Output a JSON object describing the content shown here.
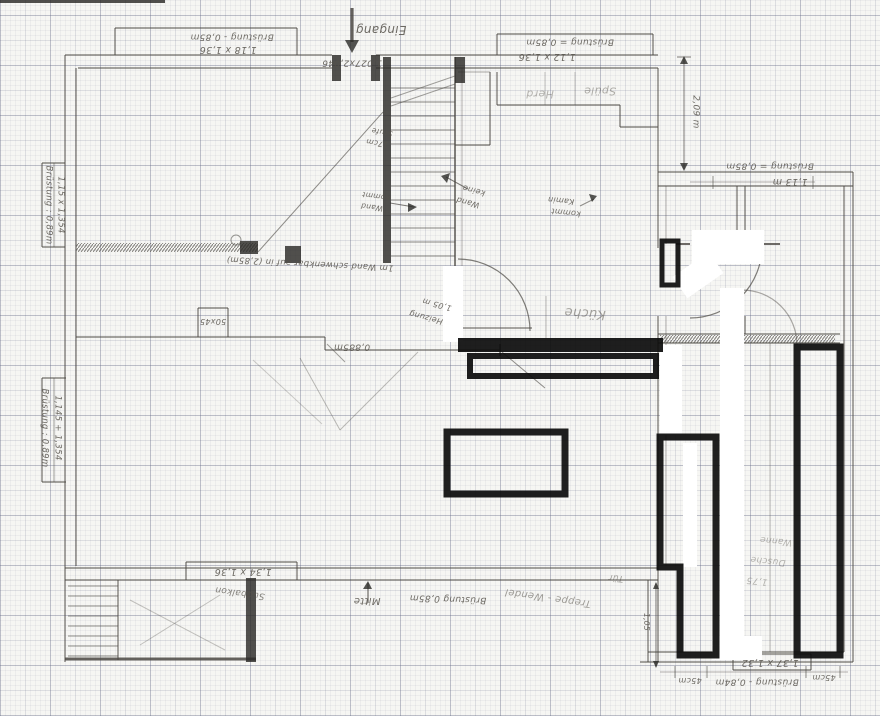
{
  "meta": {
    "title": "Handgezeichneter Grundriss auf Millimeterpapier"
  },
  "ink": {
    "pencil": "#4b4843",
    "dark": "#2b2a27",
    "marker": "#0d0d0d",
    "whiteout": "#ffffff",
    "text": "#55514a"
  },
  "labels": [
    {
      "id": "eingang",
      "t": "Eingang",
      "x": 381,
      "y": 30,
      "r": 180,
      "s": 12
    },
    {
      "id": "tuer-mass",
      "t": "1,027x2,046",
      "x": 352,
      "y": 62,
      "r": 180,
      "s": 9
    },
    {
      "id": "fenster-ol-bruestung",
      "t": "Brüstung - 0,85m",
      "x": 232,
      "y": 36,
      "r": 180,
      "s": 9
    },
    {
      "id": "fenster-ol-mass",
      "t": "1,18 x 1,36",
      "x": 228,
      "y": 49,
      "r": 180,
      "s": 9.5
    },
    {
      "id": "fenster-or-bruestung",
      "t": "Brüstung = 0,85m",
      "x": 570,
      "y": 41,
      "r": 180,
      "s": 9
    },
    {
      "id": "fenster-or-mass",
      "t": "1,12 x 1,36",
      "x": 547,
      "y": 56,
      "r": 180,
      "s": 9.5
    },
    {
      "id": "fenster-l1-bruestung",
      "t": "Brüstung : 0,89m",
      "x": 48,
      "y": 205,
      "r": 90,
      "s": 8.5
    },
    {
      "id": "fenster-l1-mass",
      "t": "1,15 x 1,354",
      "x": 60,
      "y": 205,
      "r": 90,
      "s": 8.5
    },
    {
      "id": "fenster-l2-bruestung",
      "t": "Brüstung : 0,89m",
      "x": 44,
      "y": 428,
      "r": 90,
      "s": 8.5
    },
    {
      "id": "fenster-l2-mass",
      "t": "1,145 + 1,354",
      "x": 57,
      "y": 428,
      "r": 90,
      "s": 8.5
    },
    {
      "id": "mass-50x45",
      "t": "50x45",
      "x": 213,
      "y": 321,
      "r": 180,
      "s": 8
    },
    {
      "id": "mass-0885",
      "t": "0,885m",
      "x": 352,
      "y": 346,
      "r": 180,
      "s": 9
    },
    {
      "id": "heizung-mass",
      "t": "1,05 m",
      "x": 437,
      "y": 304,
      "r": 195,
      "s": 8
    },
    {
      "id": "heizung",
      "t": "Heizung",
      "x": 426,
      "y": 317,
      "r": 195,
      "s": 8
    },
    {
      "id": "raum-kueche",
      "t": "Küche",
      "x": 585,
      "y": 313,
      "r": 184,
      "s": 13,
      "o": 0.5
    },
    {
      "id": "spuele",
      "t": "Spüle",
      "x": 600,
      "y": 91,
      "r": 180,
      "s": 11,
      "o": 0.45
    },
    {
      "id": "herd",
      "t": "Herd",
      "x": 540,
      "y": 94,
      "r": 180,
      "s": 11,
      "o": 0.4
    },
    {
      "id": "mass-209",
      "t": "2,09 m",
      "x": 695,
      "y": 112,
      "r": 90,
      "s": 9
    },
    {
      "id": "fenster-r-bruestung",
      "t": "Brüstung = 0,85m",
      "x": 770,
      "y": 165,
      "r": 180,
      "s": 9
    },
    {
      "id": "mass-113",
      "t": "1,13 m",
      "x": 790,
      "y": 181,
      "r": 180,
      "s": 9.5
    },
    {
      "id": "notiz-keine",
      "t": "keine",
      "x": 474,
      "y": 190,
      "r": 195,
      "s": 8
    },
    {
      "id": "notiz-wand1",
      "t": "Wand",
      "x": 468,
      "y": 202,
      "r": 195,
      "s": 8
    },
    {
      "id": "notiz-kommt1",
      "t": "kommt",
      "x": 376,
      "y": 196,
      "r": 188,
      "s": 7.5
    },
    {
      "id": "notiz-wand2",
      "t": "Wand",
      "x": 372,
      "y": 207,
      "r": 188,
      "s": 7.5
    },
    {
      "id": "notiz-stufe",
      "t": "Stufe",
      "x": 382,
      "y": 132,
      "r": 190,
      "s": 7.5
    },
    {
      "id": "notiz-17cm",
      "t": "17cm",
      "x": 377,
      "y": 143,
      "r": 190,
      "s": 7.5
    },
    {
      "id": "notiz-kamin",
      "t": "Kamin",
      "x": 561,
      "y": 200,
      "r": 186,
      "s": 8
    },
    {
      "id": "notiz-kommt2",
      "t": "kommt",
      "x": 566,
      "y": 212,
      "r": 186,
      "s": 8
    },
    {
      "id": "notiz-schwenkbar",
      "t": "1m Wand schwenkbar auf in (2,85m)",
      "x": 310,
      "y": 263,
      "r": 183,
      "s": 8.5
    },
    {
      "id": "fenster-u-mass",
      "t": "1,34 x 1,36",
      "x": 243,
      "y": 571,
      "r": 180,
      "s": 9.5
    },
    {
      "id": "suedbalkon",
      "t": "Südbalkon",
      "x": 240,
      "y": 592,
      "r": 188,
      "s": 9,
      "o": 0.7
    },
    {
      "id": "mitte",
      "t": "Mitte",
      "x": 367,
      "y": 600,
      "r": 180,
      "s": 10
    },
    {
      "id": "bruestung-unten",
      "t": "Brüstung 0,85m",
      "x": 448,
      "y": 598,
      "r": 182,
      "s": 9
    },
    {
      "id": "treppe-wendel",
      "t": "Treppe - Wendel",
      "x": 548,
      "y": 597,
      "r": 188,
      "s": 10,
      "o": 0.55
    },
    {
      "id": "fenster-ur-mass",
      "t": "1,37 x 1,32",
      "x": 770,
      "y": 662,
      "r": 180,
      "s": 9.5
    },
    {
      "id": "fenster-ur-bruestung",
      "t": "Brüstung - 0,84m",
      "x": 757,
      "y": 681,
      "r": 180,
      "s": 9
    },
    {
      "id": "mass-45cm-links",
      "t": "45cm",
      "x": 690,
      "y": 680,
      "r": 180,
      "s": 8
    },
    {
      "id": "mass-45cm-rechts",
      "t": "45cm",
      "x": 824,
      "y": 677,
      "r": 180,
      "s": 8
    },
    {
      "id": "notiz-wanne",
      "t": "Wanne",
      "x": 776,
      "y": 540,
      "r": 186,
      "s": 9,
      "o": 0.4
    },
    {
      "id": "notiz-dusche",
      "t": "Dusche",
      "x": 768,
      "y": 560,
      "r": 186,
      "s": 9,
      "o": 0.4
    },
    {
      "id": "notiz-175",
      "t": "1,75",
      "x": 757,
      "y": 580,
      "r": 186,
      "s": 9,
      "o": 0.4
    },
    {
      "id": "mass-105",
      "t": "1,05",
      "x": 646,
      "y": 622,
      "r": 90,
      "s": 7.5
    },
    {
      "id": "notiz-tuer",
      "t": "Tür",
      "x": 616,
      "y": 577,
      "r": 186,
      "s": 9,
      "o": 0.5
    }
  ],
  "walls": [
    [
      65,
      55,
      332,
      55
    ],
    [
      376,
      55,
      658,
      55
    ],
    [
      78,
      68,
      332,
      68
    ],
    [
      376,
      68,
      658,
      68
    ],
    [
      65,
      55,
      65,
      662
    ],
    [
      76,
      68,
      76,
      566
    ],
    [
      65,
      568,
      658,
      568
    ],
    [
      65,
      580,
      658,
      580
    ],
    [
      658,
      68,
      658,
      248
    ],
    [
      658,
      316,
      658,
      580
    ],
    [
      666,
      186,
      666,
      244,
      1,
      0.4
    ],
    [
      666,
      316,
      666,
      566,
      1,
      0.4
    ],
    [
      658,
      172,
      853,
      172
    ],
    [
      658,
      186,
      853,
      186
    ],
    [
      844,
      186,
      844,
      652
    ],
    [
      853,
      172,
      853,
      662
    ],
    [
      648,
      652,
      844,
      652
    ],
    [
      640,
      662,
      853,
      662
    ],
    [
      648,
      580,
      648,
      662
    ],
    [
      658,
      580,
      658,
      662
    ],
    [
      658,
      334,
      840,
      334
    ],
    [
      658,
      343,
      840,
      343
    ],
    [
      770,
      343,
      770,
      652,
      1,
      0.35
    ],
    [
      737,
      186,
      737,
      244
    ],
    [
      745,
      186,
      745,
      244
    ],
    [
      745,
      316,
      745,
      334
    ],
    [
      455,
      145,
      490,
      145
    ],
    [
      490,
      72,
      490,
      145
    ],
    [
      458,
      72,
      490,
      72,
      1,
      0.45
    ],
    [
      497,
      72,
      497,
      105
    ],
    [
      497,
      105,
      620,
      105
    ],
    [
      620,
      105,
      620,
      127
    ],
    [
      620,
      127,
      658,
      127
    ],
    [
      545,
      72,
      545,
      105,
      1,
      0.3
    ],
    [
      575,
      72,
      575,
      105,
      1,
      0.3
    ],
    [
      455,
      57,
      455,
      332,
      1.6,
      0.85
    ],
    [
      462,
      68,
      462,
      332,
      1,
      0.4
    ],
    [
      391,
      98,
      455,
      76,
      1,
      0.5
    ],
    [
      391,
      106,
      455,
      84,
      1,
      0.5
    ],
    [
      258,
      252,
      383,
      112,
      1,
      0.6
    ],
    [
      76,
      337,
      325,
      337
    ],
    [
      325,
      337,
      325,
      350
    ],
    [
      325,
      350,
      500,
      350
    ],
    [
      500,
      344,
      500,
      356,
      1.5,
      0.8
    ],
    [
      327,
      344,
      345,
      362,
      1,
      0.5
    ],
    [
      502,
      352,
      545,
      388,
      1,
      0.6
    ],
    [
      198,
      308,
      228,
      308
    ],
    [
      198,
      308,
      198,
      337
    ],
    [
      228,
      308,
      228,
      337
    ],
    [
      418,
      352,
      340,
      430,
      1,
      0.35
    ],
    [
      300,
      358,
      340,
      430,
      1,
      0.35
    ],
    [
      253,
      360,
      322,
      424,
      1,
      0.25
    ],
    [
      458,
      328,
      532,
      328,
      1.2,
      0.75
    ],
    [
      676,
      244,
      690,
      244,
      2,
      0.8
    ],
    [
      764,
      244,
      780,
      244,
      2,
      0.8
    ],
    [
      546,
      296,
      546,
      338,
      1,
      0.35
    ],
    [
      118,
      580,
      118,
      660
    ],
    [
      65,
      659,
      256,
      659,
      3,
      0.85
    ],
    [
      130,
      600,
      225,
      650,
      1,
      0.3
    ],
    [
      140,
      645,
      220,
      595,
      1,
      0.3
    ],
    [
      115,
      28,
      297,
      28
    ],
    [
      115,
      28,
      115,
      55
    ],
    [
      297,
      28,
      297,
      55
    ],
    [
      497,
      34,
      653,
      34
    ],
    [
      497,
      34,
      497,
      55
    ],
    [
      653,
      34,
      653,
      55
    ],
    [
      42,
      163,
      42,
      247
    ],
    [
      42,
      163,
      65,
      163
    ],
    [
      42,
      247,
      65,
      247
    ],
    [
      54,
      163,
      54,
      247,
      1,
      0.5
    ],
    [
      42,
      378,
      42,
      482
    ],
    [
      42,
      378,
      66,
      378
    ],
    [
      42,
      482,
      66,
      482
    ],
    [
      54,
      378,
      54,
      482,
      1,
      0.5
    ],
    [
      186,
      562,
      297,
      562
    ],
    [
      186,
      562,
      186,
      580
    ],
    [
      297,
      562,
      297,
      580
    ],
    [
      733,
      654,
      811,
      654
    ],
    [
      733,
      654,
      733,
      670
    ],
    [
      811,
      654,
      811,
      670
    ],
    [
      733,
      670,
      811,
      670
    ],
    [
      660,
      672,
      848,
      672,
      1,
      0.4
    ],
    [
      675,
      666,
      675,
      678,
      1,
      0.6
    ],
    [
      707,
      666,
      707,
      678,
      1,
      0.6
    ],
    [
      806,
      666,
      806,
      678,
      1,
      0.6
    ],
    [
      840,
      666,
      840,
      678,
      1,
      0.6
    ],
    [
      690,
      182,
      815,
      182,
      1,
      0.4
    ],
    [
      713,
      176,
      713,
      189,
      1,
      0.6
    ],
    [
      813,
      176,
      813,
      189,
      1,
      0.6
    ],
    [
      352,
      8,
      352,
      42,
      3.2,
      0.85
    ],
    [
      677,
      57,
      691,
      57,
      1,
      0.7
    ],
    [
      684,
      58,
      684,
      169,
      1,
      0.7
    ],
    [
      656,
      583,
      656,
      667,
      1,
      0.7
    ],
    [
      368,
      583,
      368,
      603,
      1.2,
      0.8
    ],
    [
      446,
      177,
      468,
      189,
      1,
      0.7
    ],
    [
      390,
      203,
      414,
      207,
      1,
      0.7
    ],
    [
      580,
      206,
      594,
      199,
      1,
      0.6
    ]
  ],
  "stairs": {
    "top": {
      "x1": 391,
      "x2": 455,
      "y0": 88,
      "dy": 14,
      "n": 13
    },
    "balcony": {
      "x1": 68,
      "x2": 118,
      "y0": 586,
      "dy": 10,
      "n": 8
    }
  },
  "dark_rects": [
    [
      383,
      57,
      8,
      206
    ],
    [
      332,
      55,
      9,
      26
    ],
    [
      371,
      55,
      9,
      26
    ],
    [
      455,
      57,
      10,
      26
    ],
    [
      240,
      241,
      18,
      13
    ],
    [
      285,
      246,
      16,
      17
    ],
    [
      246,
      578,
      10,
      84
    ],
    [
      0,
      0,
      165,
      3
    ]
  ],
  "hatch_rects": [
    [
      76,
      243,
      182,
      9
    ],
    [
      660,
      335,
      175,
      8
    ]
  ],
  "arcs": [
    {
      "d": "M458,259 A72,72 0 0 1 530,331"
    },
    {
      "d": "M762,246 A72,72 0 0 1 690,318"
    },
    {
      "d": "M742,290 A55,55 0 0 1 797,345",
      "o": 0.45
    }
  ],
  "circles": [
    [
      236,
      240,
      5
    ],
    [
      690,
      522,
      4
    ]
  ],
  "polys": [
    "345,40 359,40 352,53",
    "680,64 688,64 684,56",
    "680,163 688,163 684,171",
    "653,589 659,589 656,582",
    "653,661 659,661 656,668",
    "363,589 372,589 368,581",
    "441,176 450,173 447,183",
    "417,207 408,203 408,212",
    "597,196 589,194 592,202"
  ],
  "whiteout": [
    {
      "x": 720,
      "y": 288,
      "w": 24,
      "h": 368
    },
    {
      "x": 692,
      "y": 230,
      "w": 72,
      "h": 34
    },
    {
      "x": 660,
      "y": 345,
      "w": 22,
      "h": 90
    },
    {
      "x": 443,
      "y": 266,
      "w": 20,
      "h": 76
    },
    {
      "x": 712,
      "y": 636,
      "w": 50,
      "h": 24
    },
    {
      "x": 683,
      "y": 443,
      "w": 14,
      "h": 124
    },
    {
      "x": 676,
      "y": 262,
      "w": 44,
      "h": 26,
      "rot": -35
    }
  ],
  "marker": {
    "filled": [
      {
        "x": 458,
        "y": 338,
        "w": 205,
        "h": 14
      }
    ],
    "outlined": [
      {
        "x": 470,
        "y": 356,
        "w": 186,
        "h": 20,
        "sw": 6
      },
      {
        "x": 447,
        "y": 432,
        "w": 118,
        "h": 62,
        "sw": 7
      },
      {
        "x": 797,
        "y": 347,
        "w": 43,
        "h": 308,
        "sw": 7
      },
      {
        "x": 662,
        "y": 241,
        "w": 16,
        "h": 44,
        "sw": 5
      }
    ],
    "paths": [
      {
        "d": "M660,437 L716,437 L716,655 L680,655 L680,567 L660,567 Z",
        "sw": 7
      }
    ]
  }
}
